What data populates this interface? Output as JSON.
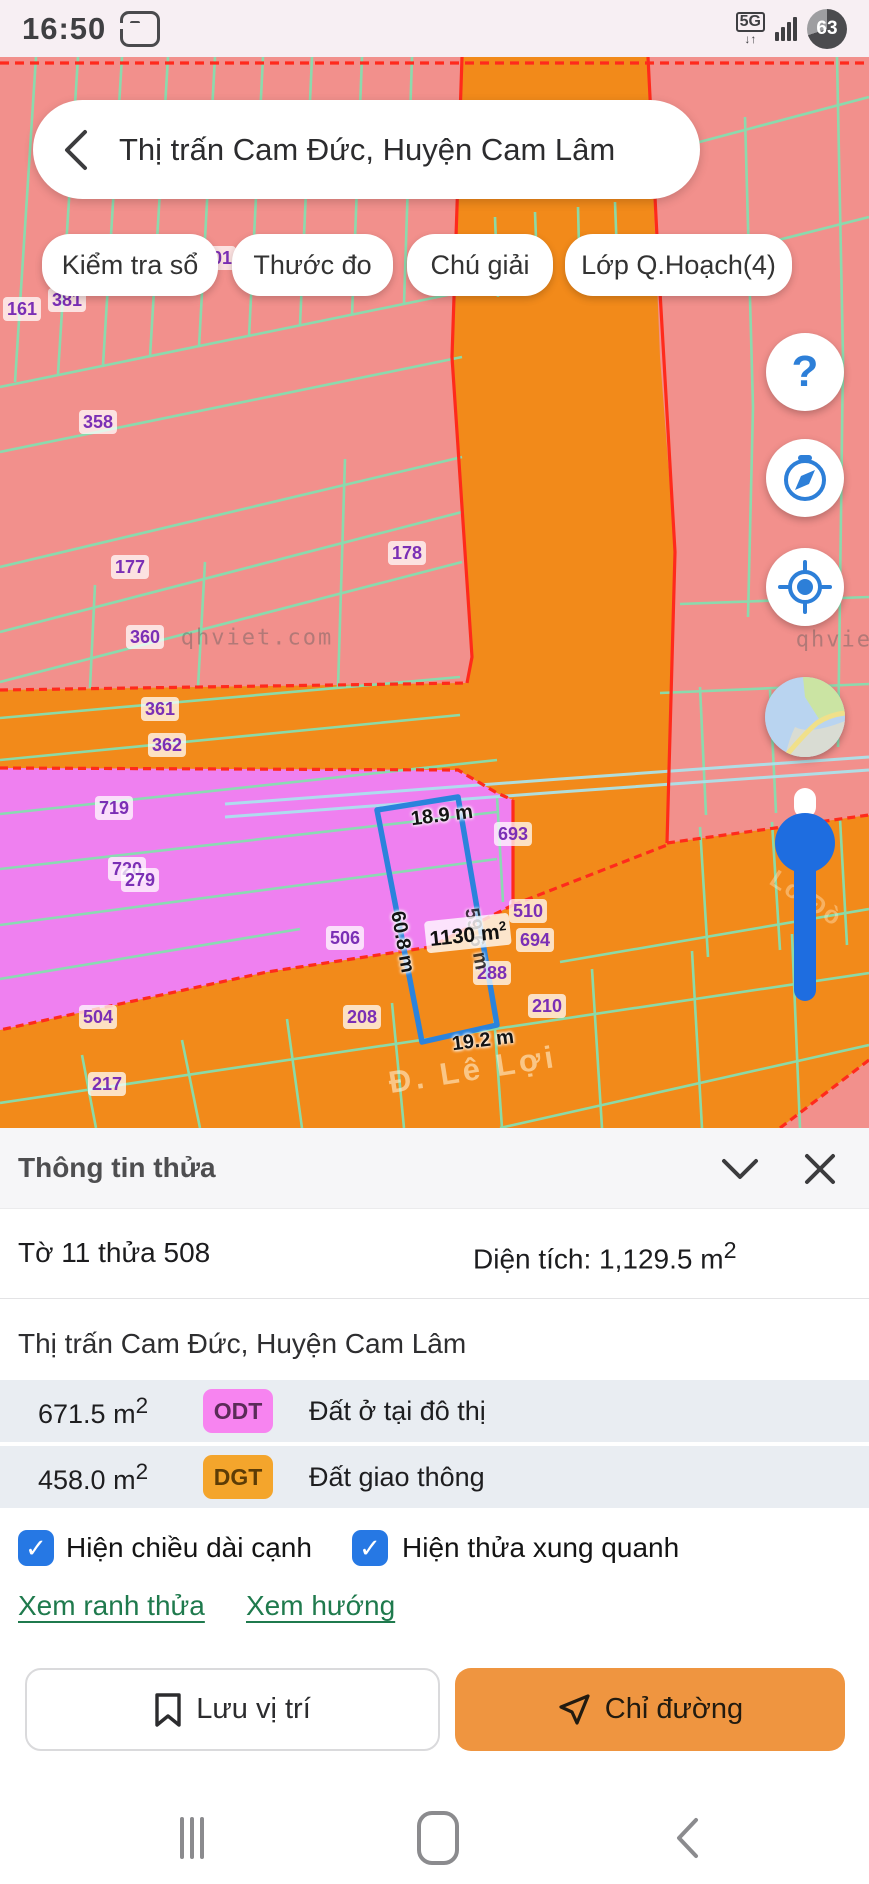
{
  "status_bar": {
    "time": "16:50",
    "network": "5G",
    "battery": "63"
  },
  "search_bar": {
    "query": "Thị trấn Cam Đức, Huyện Cam Lâm"
  },
  "map_toolbar": {
    "buttons": [
      {
        "label": "Kiểm tra sổ",
        "x": 42,
        "w": 176
      },
      {
        "label": "Thước đo",
        "x": 232,
        "w": 161
      },
      {
        "label": "Chú giải",
        "x": 407,
        "w": 146
      },
      {
        "label": "Lớp Q.Hoạch(4)",
        "x": 565,
        "w": 227
      }
    ]
  },
  "map": {
    "colors": {
      "residential_pink": "#F2908C",
      "traffic_orange": "#F28A1A",
      "urban_magenta": "#EF80F0",
      "parcel_line": "#86DFAF",
      "zone_line": "#FF2A1C",
      "selection_blue": "#2B83DC"
    },
    "labels": [
      {
        "type": "wm",
        "text": "qhviet.com",
        "x": 257,
        "y": 581
      },
      {
        "type": "wm",
        "text": "qhviet.com",
        "x": 872,
        "y": 583
      },
      {
        "type": "road",
        "text": "Đ. Lê Lợi",
        "x": 473,
        "y": 1013,
        "rot": -9
      },
      {
        "type": "roadfaint",
        "text": "Lò Đò",
        "x": 806,
        "y": 842,
        "rot": 33
      },
      {
        "type": "parcel",
        "text": "161",
        "x": 22,
        "y": 252
      },
      {
        "type": "parcel",
        "text": "381",
        "x": 67,
        "y": 243
      },
      {
        "type": "parcel",
        "text": "01",
        "x": 222,
        "y": 201
      },
      {
        "type": "parcel",
        "text": "358",
        "x": 98,
        "y": 365
      },
      {
        "type": "parcel",
        "text": "177",
        "x": 130,
        "y": 510
      },
      {
        "type": "parcel",
        "text": "178",
        "x": 407,
        "y": 496
      },
      {
        "type": "parcel",
        "text": "360",
        "x": 145,
        "y": 580
      },
      {
        "type": "parcel",
        "text": "361",
        "x": 160,
        "y": 652
      },
      {
        "type": "parcel",
        "text": "362",
        "x": 167,
        "y": 688
      },
      {
        "type": "parcel",
        "text": "719",
        "x": 114,
        "y": 751
      },
      {
        "type": "parcel",
        "text": "720",
        "x": 127,
        "y": 812
      },
      {
        "type": "parcel",
        "text": "279",
        "x": 140,
        "y": 823
      },
      {
        "type": "parcel",
        "text": "693",
        "x": 513,
        "y": 777
      },
      {
        "type": "parcel",
        "text": "506",
        "x": 345,
        "y": 881
      },
      {
        "type": "parcel",
        "text": "510",
        "x": 528,
        "y": 854
      },
      {
        "type": "parcel",
        "text": "694",
        "x": 535,
        "y": 883
      },
      {
        "type": "parcel",
        "text": "288",
        "x": 492,
        "y": 916
      },
      {
        "type": "parcel",
        "text": "208",
        "x": 362,
        "y": 960
      },
      {
        "type": "parcel",
        "text": "210",
        "x": 547,
        "y": 949
      },
      {
        "type": "parcel",
        "text": "504",
        "x": 98,
        "y": 960
      },
      {
        "type": "parcel",
        "text": "217",
        "x": 107,
        "y": 1027
      },
      {
        "type": "dimfaint",
        "text": "59.6 m",
        "x": 476,
        "y": 882,
        "rot": 80
      },
      {
        "type": "dim",
        "text": "18.9 m",
        "x": 442,
        "y": 759,
        "rot": -7
      },
      {
        "type": "dim",
        "text": "60.8 m",
        "x": 402,
        "y": 885,
        "rot": 80
      },
      {
        "type": "dim",
        "text": "19.2 m",
        "x": 483,
        "y": 984,
        "rot": -7
      },
      {
        "type": "area",
        "text": "1130 m",
        "sup": "2",
        "x": 468,
        "y": 876,
        "rot": -6
      }
    ]
  },
  "fabs": {
    "help": "?"
  },
  "bottom_sheet": {
    "title": "Thông tin thửa",
    "parcel_id": "Tờ 11 thửa 508",
    "area_label": "Diện tích: 1,129.5 m",
    "area_sup": "2",
    "address": "Thị trấn Cam Đức, Huyện Cam Lâm",
    "land_rows": [
      {
        "area": "671.5 m",
        "sup": "2",
        "code": "ODT",
        "desc": "Đất ở tại đô thị"
      },
      {
        "area": "458.0 m",
        "sup": "2",
        "code": "DGT",
        "desc": "Đất giao thông"
      }
    ],
    "checkboxes": [
      {
        "label": "Hiện chiều dài cạnh",
        "checked": true,
        "glyph": "✓"
      },
      {
        "label": "Hiện thửa xung quanh",
        "checked": true,
        "glyph": "✓"
      }
    ],
    "links": [
      {
        "label": "Xem ranh thửa"
      },
      {
        "label": "Xem hướng"
      }
    ],
    "actions": {
      "save": "Lưu vị trí",
      "directions": "Chỉ đường"
    }
  }
}
